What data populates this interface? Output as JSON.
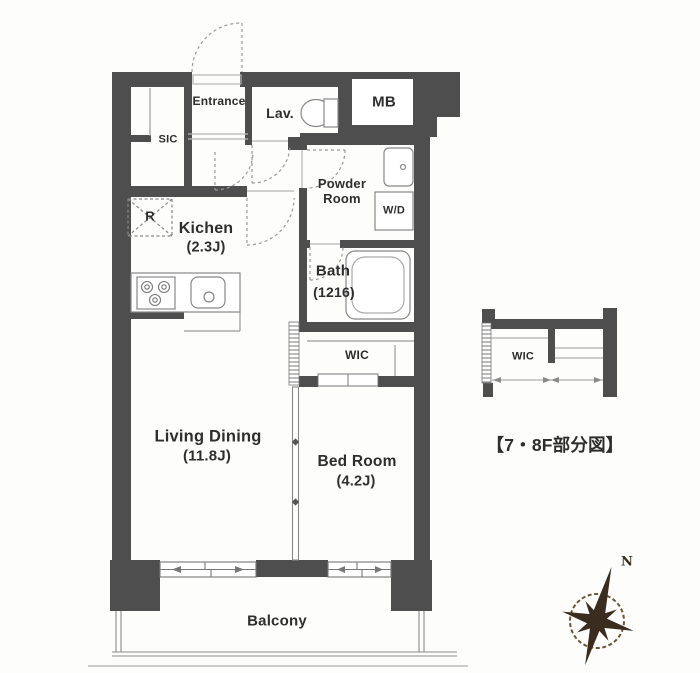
{
  "floor_plan": {
    "rooms": {
      "entrance": {
        "label": "Entrance"
      },
      "sic": {
        "label": "SIC"
      },
      "lavatory": {
        "label": "Lav."
      },
      "meter_box": {
        "label": "MB"
      },
      "powder_room": {
        "label": "Powder Room"
      },
      "washer_dryer": {
        "label": "W/D"
      },
      "kitchen": {
        "label": "Kichen",
        "area": "(2.3J)"
      },
      "refrigerator_space": {
        "label": "R"
      },
      "bath": {
        "label": "Bath",
        "size": "(1216)"
      },
      "walk_in_closet": {
        "label": "WIC"
      },
      "living_dining": {
        "label": "Living Dining",
        "area": "(11.8J)"
      },
      "bed_room": {
        "label": "Bed Room",
        "area": "(4.2J)"
      },
      "balcony": {
        "label": "Balcony"
      }
    },
    "partial_diagram": {
      "walk_in_closet_label": "WIC",
      "caption": "【7・8F部分図】"
    },
    "compass": {
      "north_label": "N"
    },
    "colors": {
      "wall": "#4e4e4e",
      "line": "#8a8a8a",
      "compass": "#3a2d20",
      "text": "#2e2e2e"
    }
  }
}
